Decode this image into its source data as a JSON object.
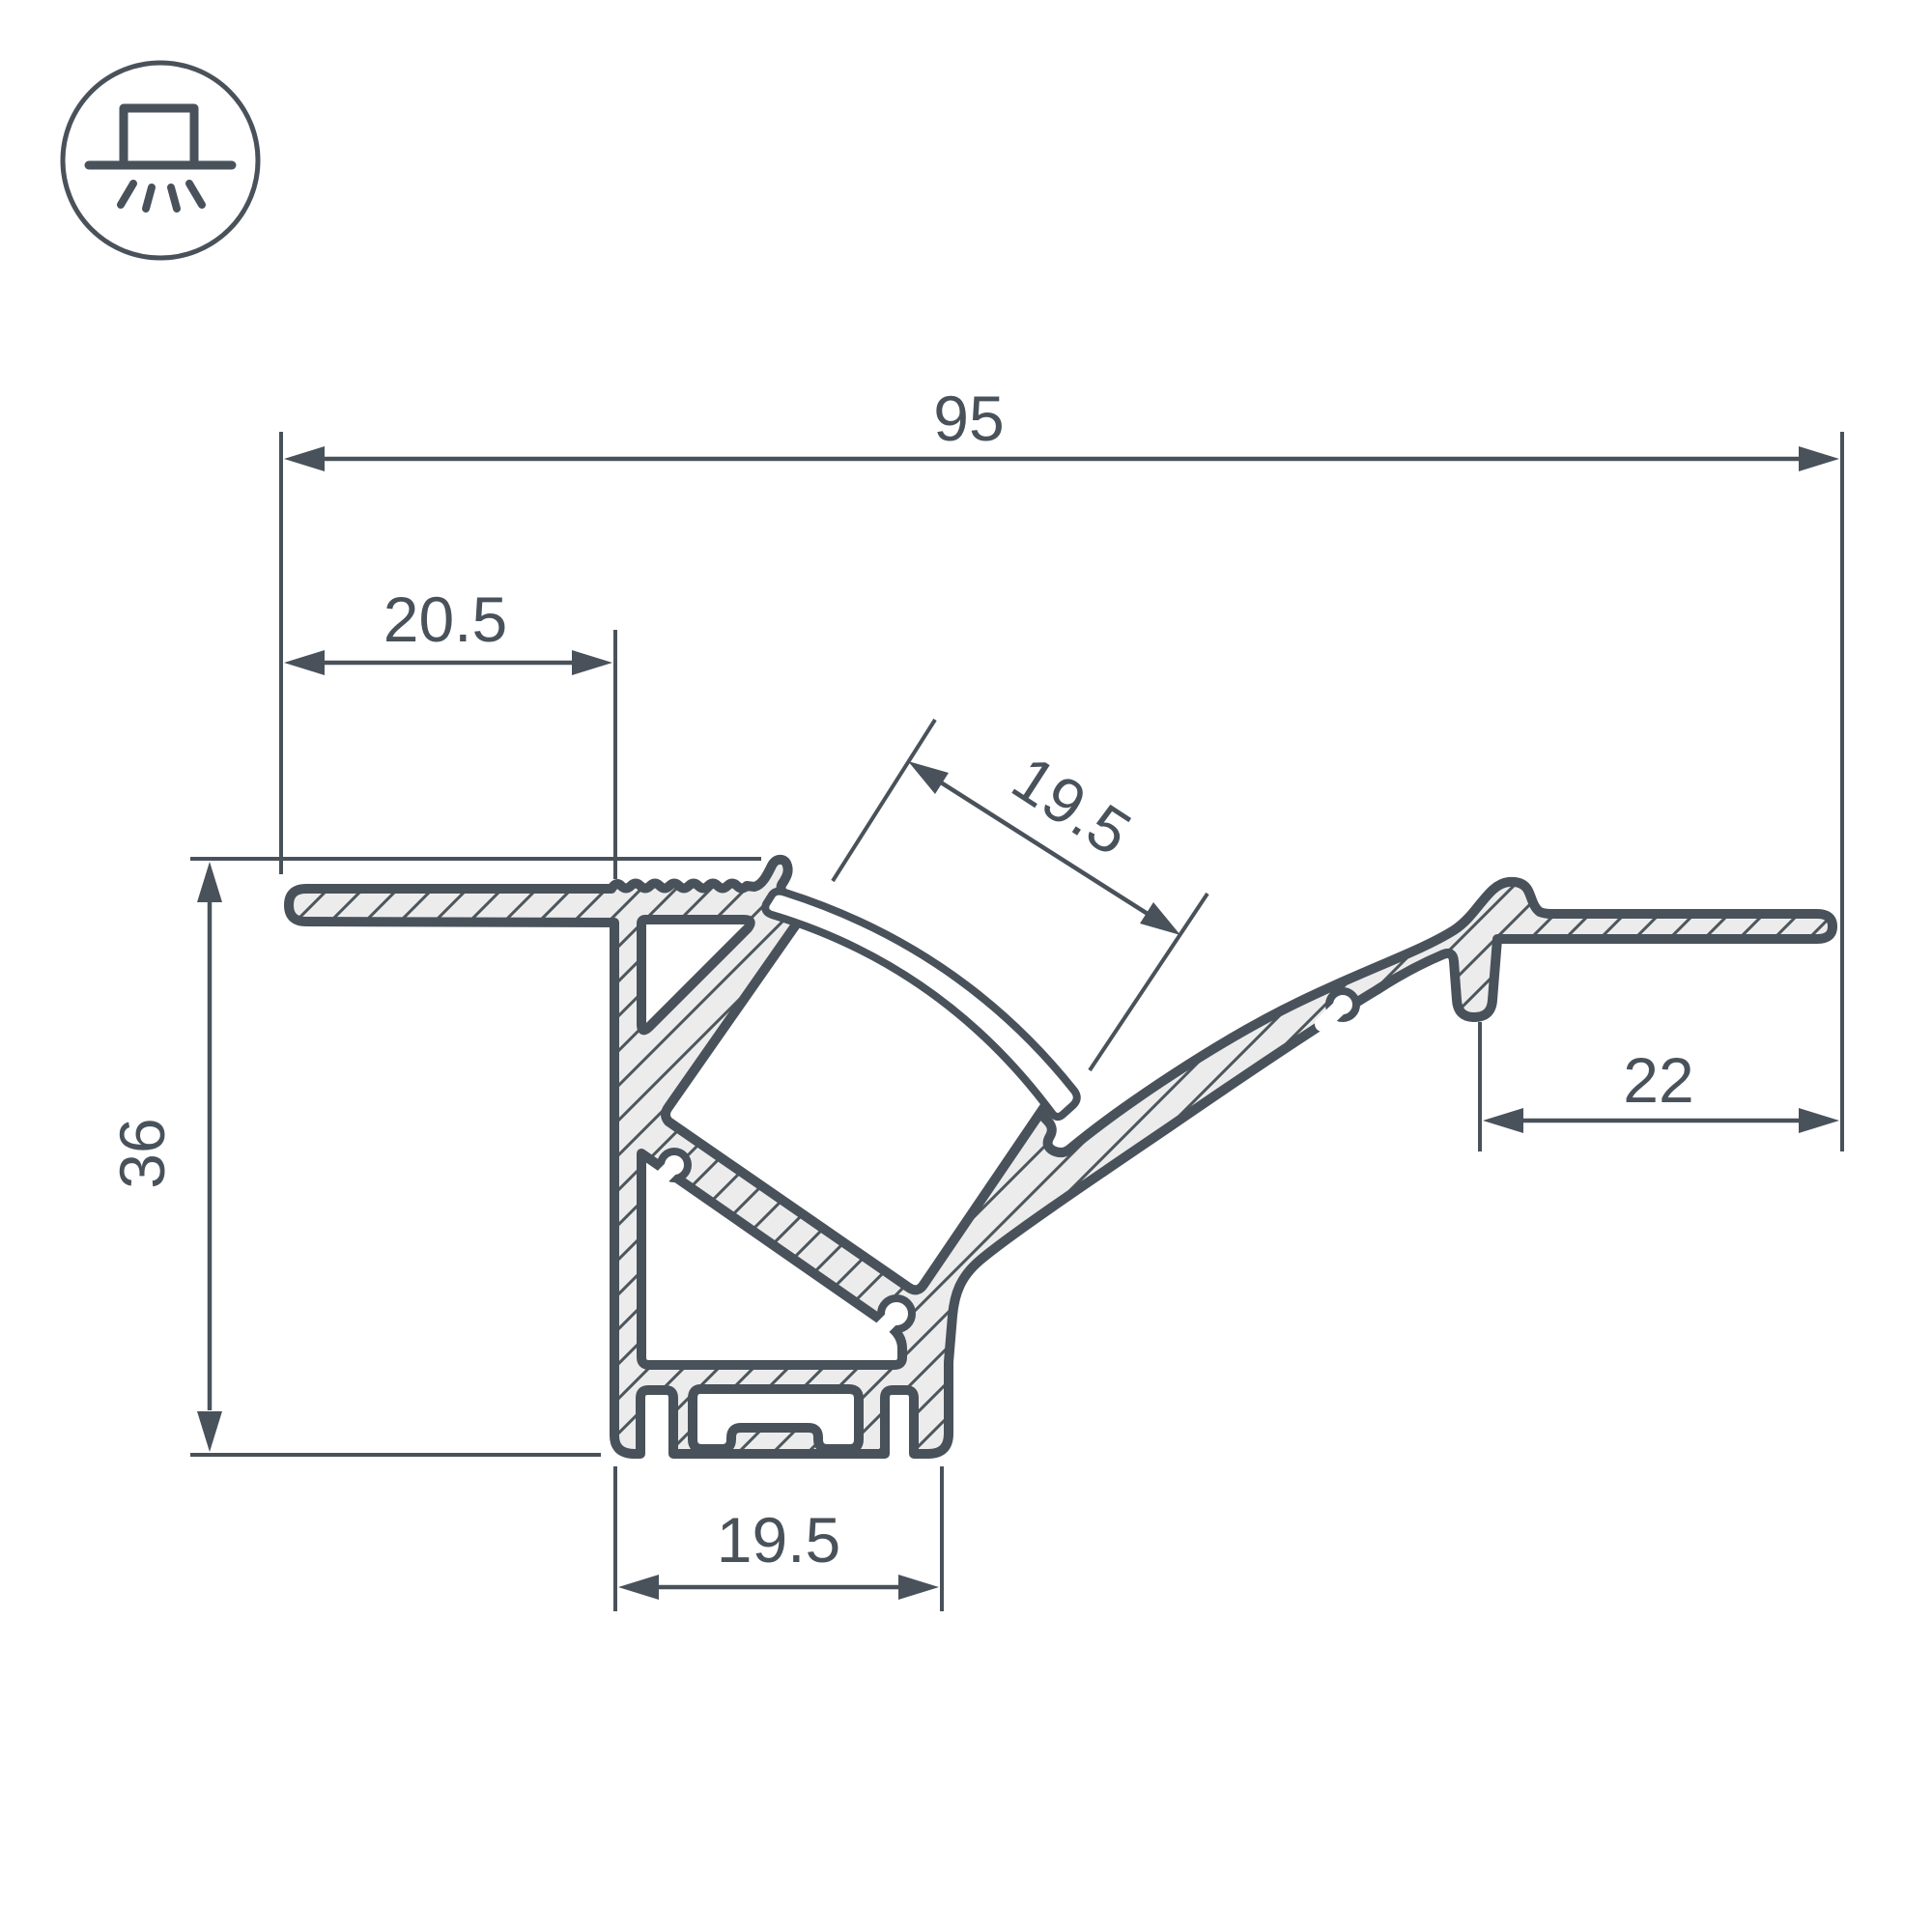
{
  "drawing": {
    "icon": {
      "name": "recessed-light-icon"
    },
    "dimensions": {
      "overall_width": "95",
      "left_flange_width": "20.5",
      "diffuser_opening": "19.5",
      "overall_height": "36",
      "right_flange_width": "22",
      "base_width": "19.5"
    },
    "colors": {
      "ink": "#49525a",
      "metal_fill": "#ececec",
      "background": "#ffffff"
    }
  }
}
